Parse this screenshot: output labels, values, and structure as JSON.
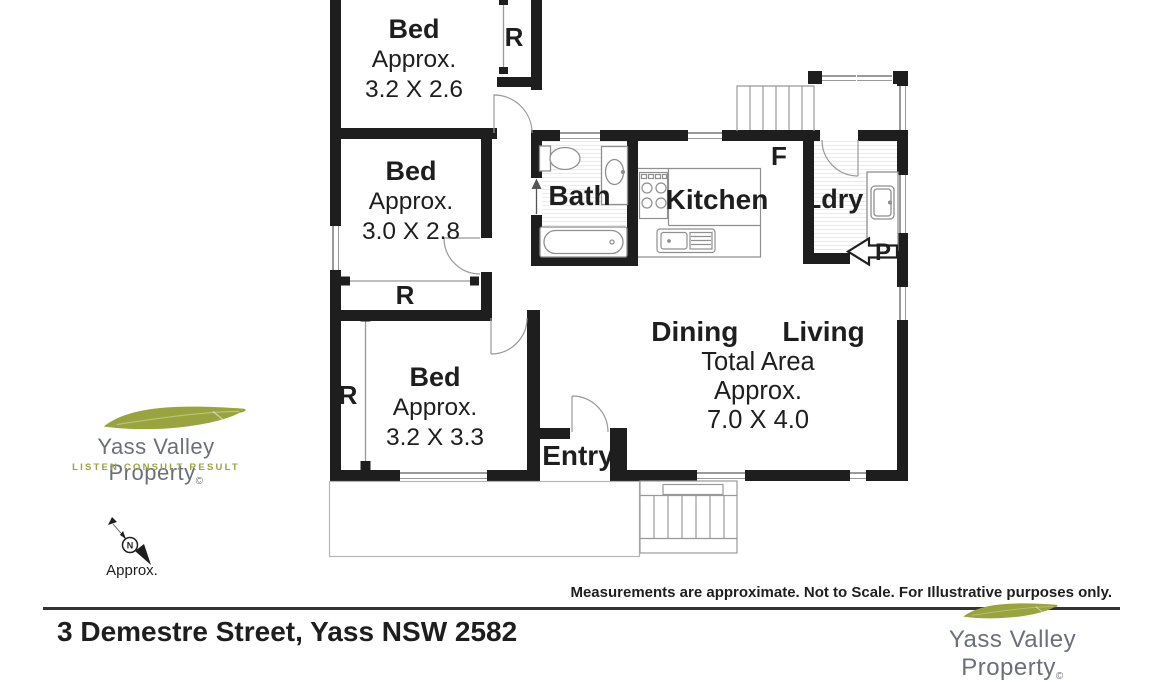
{
  "floorplan": {
    "rooms": {
      "bed1": {
        "name": "Bed",
        "approx": "Approx.",
        "dims": "3.2 X 2.6"
      },
      "bed2": {
        "name": "Bed",
        "approx": "Approx.",
        "dims": "3.0 X 2.8"
      },
      "bed3": {
        "name": "Bed",
        "approx": "Approx.",
        "dims": "3.2 X 3.3"
      },
      "bath": {
        "name": "Bath"
      },
      "kitchen": {
        "name": "Kitchen"
      },
      "laundry": {
        "name": "Ldry"
      },
      "entry": {
        "name": "Entry"
      },
      "dining_living": {
        "dining": "Dining",
        "living": "Living",
        "line2": "Total Area",
        "line3": "Approx.",
        "line4": "7.0 X 4.0"
      }
    },
    "markers": {
      "robe": "R",
      "fridge": "F",
      "porch": "P"
    }
  },
  "compass": {
    "north": "N",
    "caption": "Approx."
  },
  "footer": {
    "address": "3 Demestre Street, Yass NSW 2582",
    "disclaimer": "Measurements are approximate. Not to Scale. For Illustrative purposes only."
  },
  "branding": {
    "left": {
      "name": "Yass Valley Property",
      "mark": "©",
      "tagline": "LISTEN CONSULT RESULT"
    },
    "right": {
      "name": "Yass Valley Property",
      "mark": "©"
    }
  },
  "colors": {
    "wall": "#1e1e1e",
    "leaf_green": "#9aa43e",
    "brand_gray": "#6a6f79",
    "line_gray": "#999999"
  }
}
